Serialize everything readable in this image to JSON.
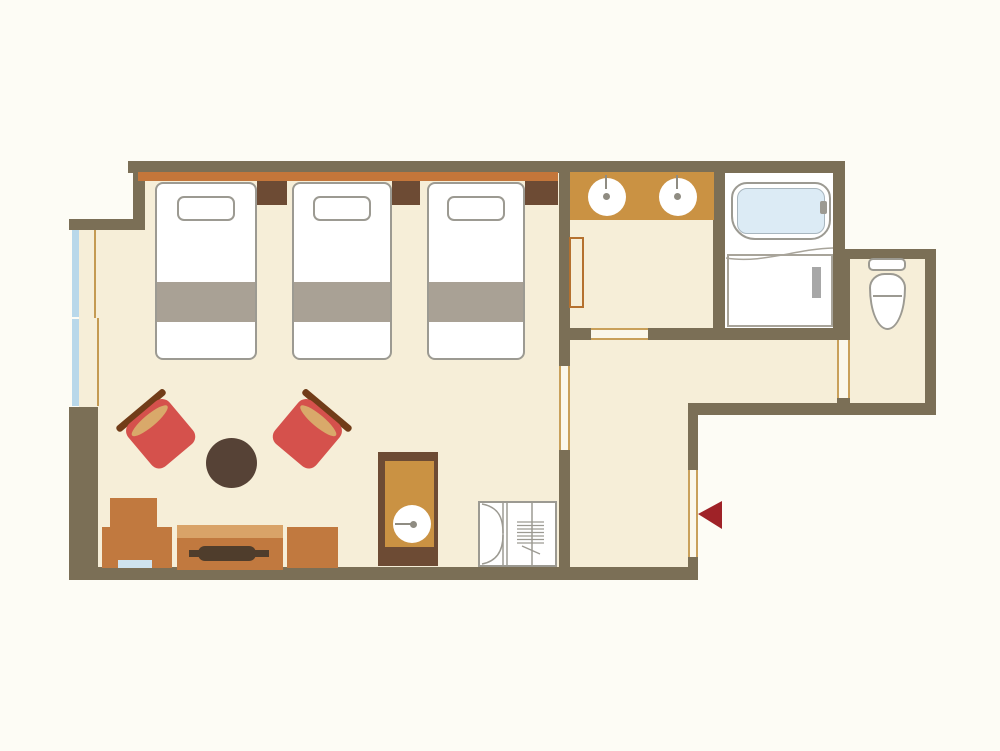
{
  "plan": {
    "title": "Hotel guest room floor plan",
    "legend": {
      "entrance_marker": "red-arrow-pointing-into-room"
    },
    "colors": {
      "wall": "#7b6f56",
      "floor": "#f6eed8",
      "headboard_orange": "#c4763a",
      "counter_tan": "#ca9243",
      "dark_brown": "#6d4b34",
      "furniture_brown": "#c1793f",
      "window_blue": "#b9d8ea",
      "tub_blue": "#dcebf5",
      "chair_red": "#d5514c",
      "blanket_gray": "#a9a195",
      "outline_gray": "#9c9a92",
      "arrow_red": "#9f2227",
      "door_opening_line": "#c9a05a"
    },
    "counts": {
      "beds": 3,
      "pillows": 3,
      "armchairs": 2,
      "wash_basins": 2,
      "bathtubs": 1,
      "toilets": 1
    },
    "rooms": [
      {
        "name": "Bedroom",
        "fixtures": [
          "single-bed",
          "single-bed",
          "single-bed",
          "nightstand",
          "nightstand",
          "nightstand",
          "armchair",
          "armchair",
          "round-table",
          "tv-board",
          "tv",
          "refrigerator-cabinet",
          "side-box",
          "cabinet",
          "minibar-sink-unit",
          "bifold-door-closet",
          "window",
          "curtain"
        ]
      },
      {
        "name": "Washroom",
        "fixtures": [
          "vanity-counter",
          "wash-basin",
          "wash-basin",
          "towel-rack"
        ]
      },
      {
        "name": "Bathroom",
        "fixtures": [
          "bathtub",
          "bath-door"
        ]
      },
      {
        "name": "Toilet room",
        "fixtures": [
          "toilet"
        ]
      },
      {
        "name": "Entrance hall",
        "fixtures": [
          "entrance-opening",
          "entrance-arrow"
        ]
      }
    ]
  }
}
